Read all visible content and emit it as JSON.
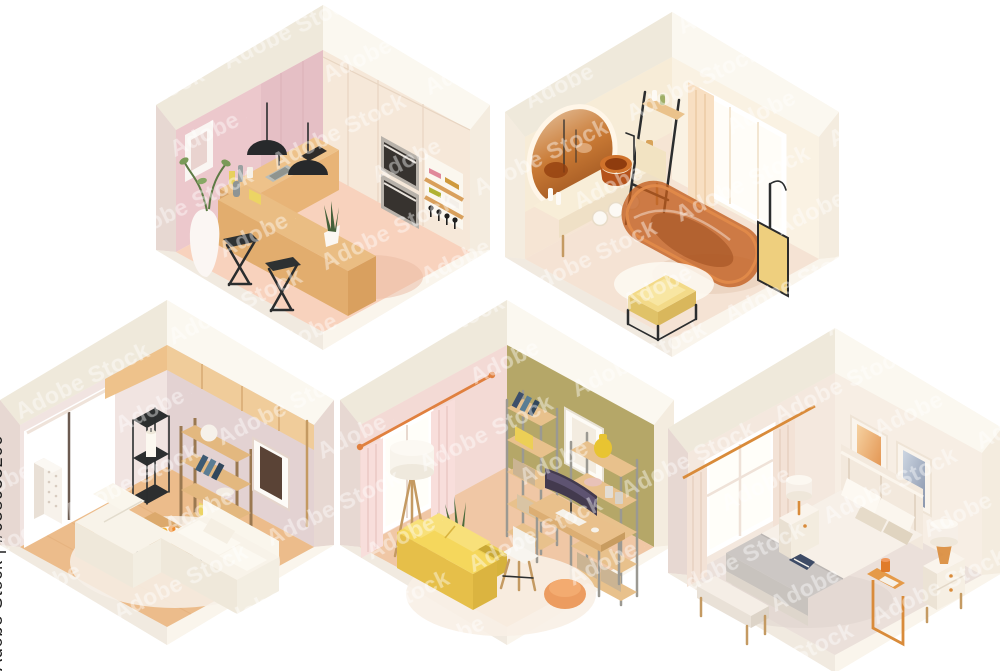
{
  "watermark": {
    "side_label": "Adobe Stock | #658955266",
    "tile_text": "Adobe Stock",
    "tile_color": "#ffffff",
    "side_label_color": "#1e1e1e",
    "stock_id": "#658955266"
  },
  "scene": {
    "background": "#ffffff",
    "description": "Five isometric hexagonal room cutaways: kitchen, bathroom, living room, home office, bedroom",
    "shell": {
      "base": "#f6f2e9",
      "top_left": "#efe9db",
      "top_right": "#fbf8f0",
      "strip_left": "#e7d8d2",
      "strip_right": "#f4ecdf",
      "slab_left": "#f1eae0",
      "slab_right": "#faf5ec"
    },
    "rooms": {
      "kitchen": {
        "label": "kitchen with bar counter",
        "wall_left": "#ecc8cc",
        "wall_right": "#f6e8d9",
        "floor": "#f8d2bd",
        "cabinet_pink": "#e5bfc5",
        "island_wood": "#eabd83",
        "island_front": "#e2ad6e",
        "counter_wood": "#eec28a",
        "stool": "#2e3132",
        "pendant": "#27292b",
        "vase": "#fbf6f3",
        "plant": "#45603a",
        "oven_glass": "#37332f",
        "oven_steel": "#b8b2aa",
        "niche": "#fbf7ef",
        "shelf_wood": "#d9a05c",
        "plates": [
          "#e0889a",
          "#cf9a3d",
          "#b0b233",
          "#f4efe8"
        ],
        "shadow": "#eab9a2"
      },
      "bathroom": {
        "label": "bathroom with amber glass tub",
        "wall_left": "#f7ecd7",
        "wall_right": "#faf2e3",
        "floor": "#f5e3d4",
        "tub": "#c25c1c",
        "tub_rim": "#e08a4a",
        "tub_inner": "#8a3c10",
        "mirror_rim": "#fff6e8",
        "vanity": "#f8eed8",
        "vanity_apron": "#efe0c6",
        "sink": "#b5521a",
        "ottoman": "#f3da88",
        "ottoman_side": "#e0c268",
        "screen": "#eecf7e",
        "frame_black": "#2b2b2b",
        "curtain": "#f8dfc2",
        "window": "#fffdf8",
        "rug": "#fdf8f1",
        "towel": "#f2e3c2"
      },
      "living": {
        "label": "living room with white sofas",
        "wall_left": "#f1e4e1",
        "wall_right": "#e3d2d2",
        "floor": "#ecbc8b",
        "sofa": "#f8f3e9",
        "sofa_front": "#efe8da",
        "sofa_side": "#f3eee2",
        "table_wood": "#dca96c",
        "table_edge": "#c08c52",
        "tower_black": "#2c2e2f",
        "shelf_wood": "#e3b87f",
        "beam_wood": "#f0cc9a",
        "rug": "#f7f0e7",
        "window": "#ffffff",
        "speaker": "#f7f2eb",
        "candle": "#fcf8f0",
        "art": "#5a4336",
        "fruit_a": "#f2b33c",
        "fruit_b": "#ef8c2e"
      },
      "office": {
        "label": "home office with yellow sofa",
        "wall_left": "#f3dad5",
        "wall_right": "#b5a768",
        "floor": "#f0c7a5",
        "sofa": "#f5d75c",
        "sofa_shade": "#e6bf49",
        "pouf": "#ec9c60",
        "desk_wood": "#e9c08b",
        "monitor": "#433a4e",
        "chair": "#f4f1ea",
        "curtain": "#f8dedb",
        "rod": "#e0803f",
        "rug": "#f8efe5",
        "shelf_wood": "#e8c18c",
        "shelf_metal": "#9b9992",
        "plant": "#4c6b3c",
        "bin_yellow": "#eccf56",
        "vase_yellow": "#e8c431",
        "basket": "#cbb493",
        "lamp": "#f8f4ec",
        "window": "#fffef9",
        "frame": "#fdfbf6",
        "book_navy": "#3d4f6b"
      },
      "bedroom": {
        "label": "bedroom with double bed",
        "wall_left": "#f4e8de",
        "wall_right": "#f7eee4",
        "floor": "#ebe0da",
        "bed": "#f7f0e8",
        "bed_side": "#ece4d8",
        "blanket": "#ccc7c4",
        "blanket_dark": "#c2bdba",
        "headboard": "#f3e9dd",
        "pillow_white": "#fdf9f2",
        "pillow_taupe": "#e6dbc9",
        "bench": "#f5eee6",
        "nightstand": "#faf4ec",
        "table_gold": "#d98b3a",
        "lamp": "#f6efe7",
        "art_warm": "#eeb078",
        "art_cool": "#a9b3c6",
        "curtain": "#f3e2d6",
        "window": "#fffef9",
        "book": "#3d4b66",
        "cup": "#e07b2a",
        "shadow": "#ddd2cc"
      }
    }
  }
}
